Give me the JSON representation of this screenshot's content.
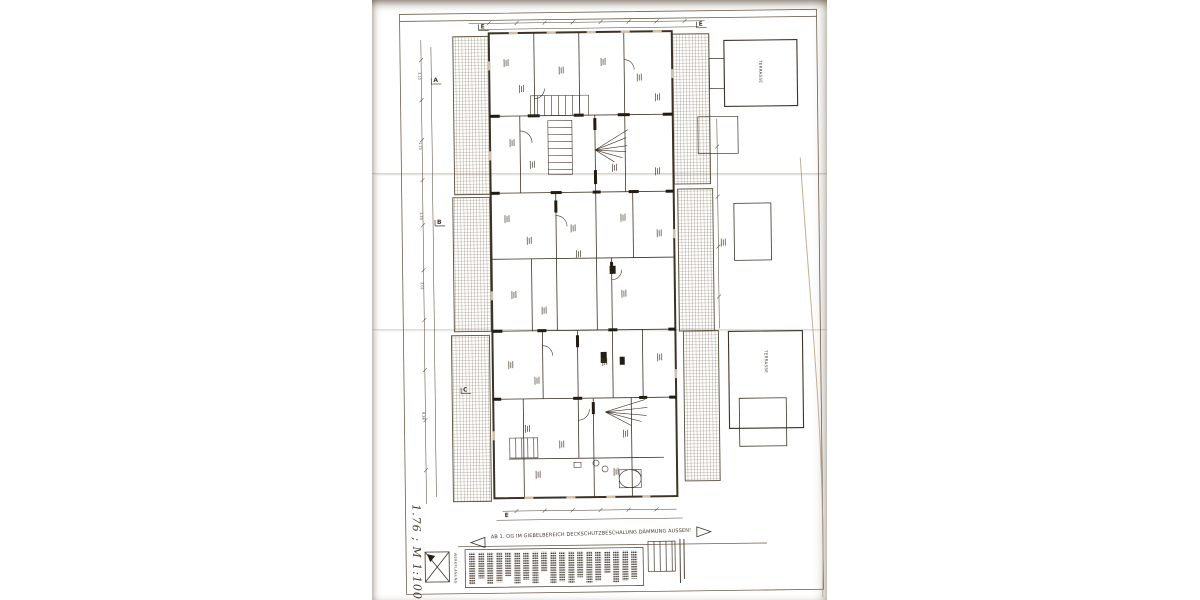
{
  "scene": {
    "description": "Photograph of a creased architectural floor-plan sheet (Werkplanung, attic storey), drawing rotated on the page",
    "paper_color": "#d5bfa8",
    "background_color": "#ffffff",
    "ink_color": "#43382b"
  },
  "plan": {
    "handwritten_note": "1.76 ; M 1:100",
    "scale": "M 1:100",
    "annotation": "AB 1. OG IM GIEBELBEREICH DECKSCHUTZBESCHALUNG DÄMMUNG AUSSEN!",
    "werkplan_label": "WERKPLANUNG",
    "terrace_label": "TERRASSE",
    "section_markers": {
      "e_top_left": "E",
      "e_top_right": "E",
      "a": "A",
      "b": "B",
      "c": "C",
      "e_bottom": "E"
    },
    "dimensions": {
      "left": [
        "3.10",
        "1.73",
        "2.33",
        "2.01",
        "8.36"
      ]
    }
  }
}
